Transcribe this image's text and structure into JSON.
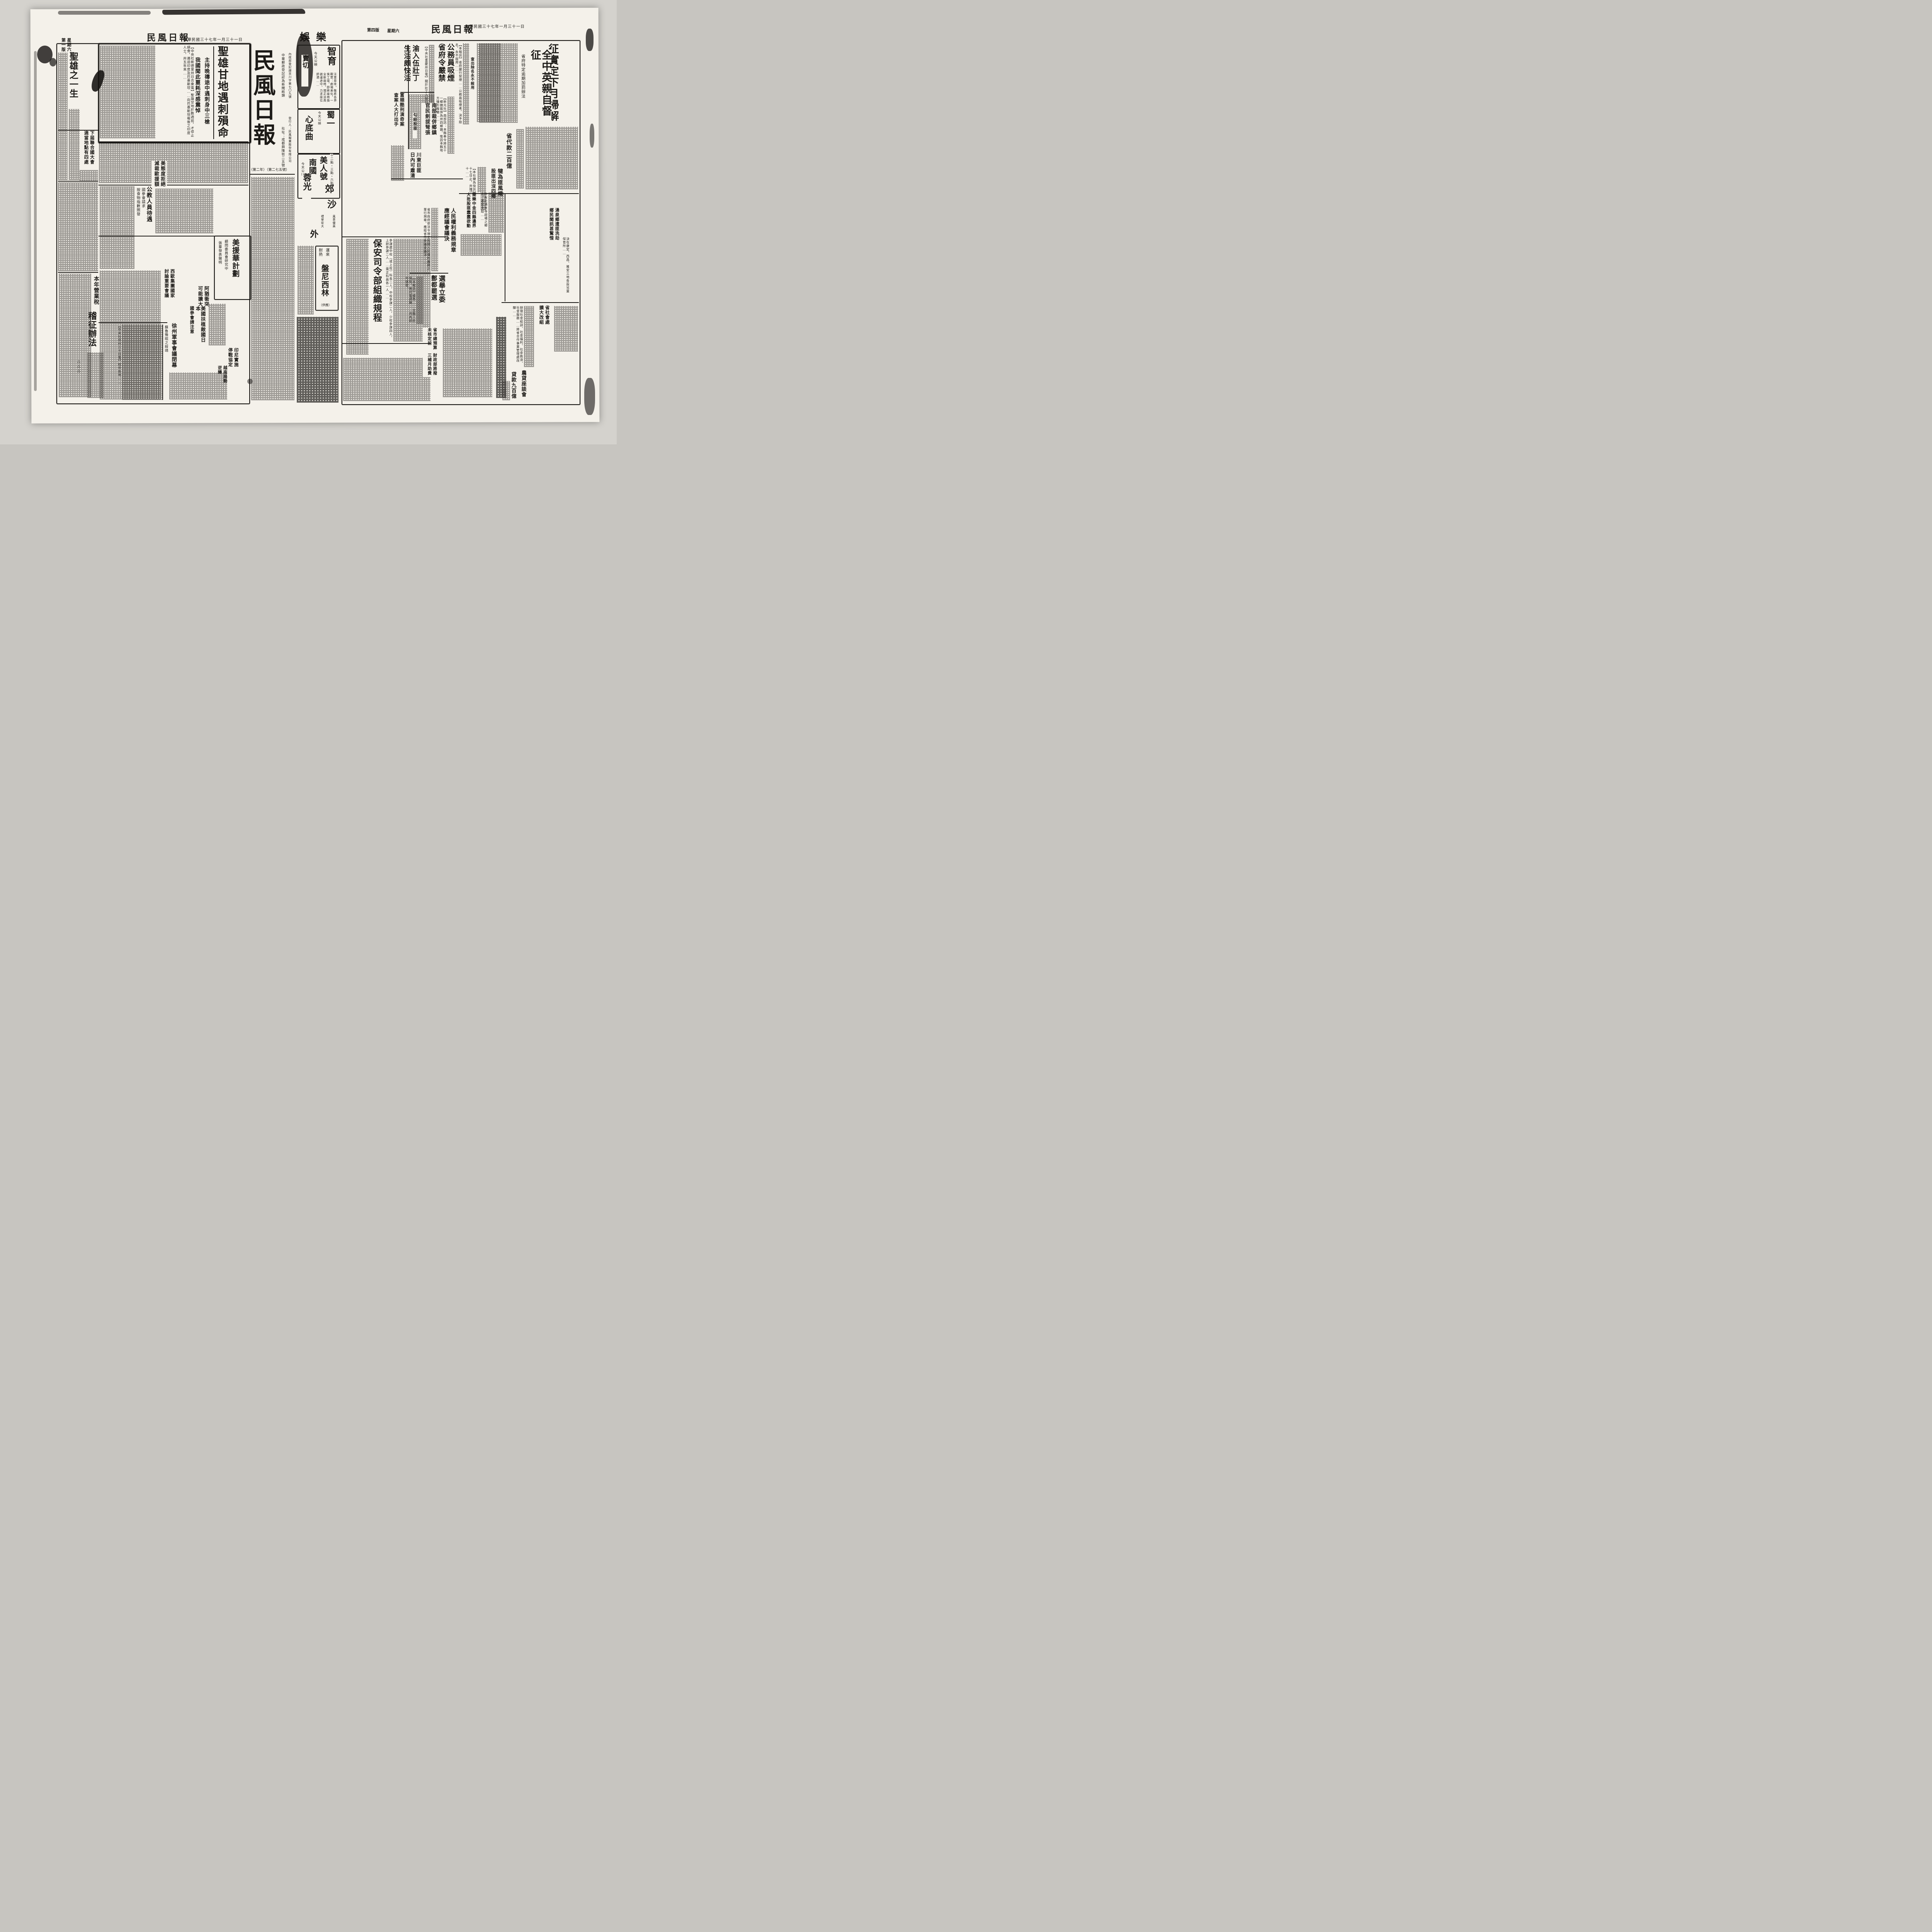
{
  "meta": {
    "paper_name": "民風日報",
    "date_line": "中華民國三十七年一月三十一日",
    "weekday": "星期六",
    "edition_left": "第一版",
    "edition_right": "第四版",
    "postal_reg": "中華郵政登記認為新聞紙類",
    "address": "社址：成都興隆街二五號",
    "license": "內政部登記證京川字第七〇九號",
    "publisher": "發行人：民風報業股份有限公司",
    "issue_no": "（第二年）（第二七五號）",
    "ink_color": "#1c1a17",
    "paper_color": "#f4f1ea"
  },
  "left": {
    "editorial_title": "聖雄之一生",
    "un": {
      "l1": "下屆聯合國大會",
      "l2": "適當地點有四處"
    },
    "gandhi": {
      "headline": "聖雄甘地遇刺殞命",
      "sub1": "主持晚禱途中遇刺身中三槍",
      "sub2": "我國聞此噩耗深感震悼",
      "body": "【中央社新德里卅日合衆電】聖雄甘地於數週前，才停止絕食，遏迫印度及巴基斯坦……向巴基斯坦報後之印度人士，卅五年來……"
    },
    "us_refusal": {
      "l1": "美態度拒絕",
      "l2": "減裁歐援額"
    },
    "pay": {
      "headline": "公教人員待遇",
      "sub1": "國參會請求",
      "sub2": "按食物指數照發"
    },
    "westbloc": {
      "l1": "西歐集團國家",
      "l2": "討論重要會議"
    },
    "aid": {
      "headline": "美援華計劃",
      "sub1": "顧問委員會研究中",
      "sub2": "張羣發表聲明"
    },
    "arab": {
      "l1": "阿猶衝突",
      "l2": "可能擴大"
    },
    "japan": {
      "l1": "美國扶植敵國日本",
      "l2": "國參會請注意"
    },
    "xuzhou": {
      "headline": "徐州軍事會議閉幕",
      "sub": "蘇魯豫晥之綏靖",
      "body": "【中央社徐州三十日電】晥中各地……"
    },
    "indo": {
      "l1": "印尼實施",
      "l2": "停戰協定"
    },
    "viet": {
      "l1": "越南局勢",
      "l2": "逆轉"
    },
    "tax": {
      "kicker": "本年營業稅",
      "headline": "稽征辦法"
    },
    "marks": "△△△"
  },
  "gutter": {
    "section": "娛樂",
    "cinema1": {
      "name": "智育",
      "note": "今天公映",
      "glyphs": "賣切",
      "notice": "注意是幸。敬希各界觀眾：劇場美化，一俟工竣，即將座椅換全新座椅，現正派員啟運途中，力求座位舒適……"
    },
    "cinema2": {
      "name": "蜀一",
      "film": "心底曲",
      "note": "今天公映"
    },
    "cinema3": {
      "name": "南國",
      "film": "美人號",
      "note": "今天公映",
      "times": "十二點・三點・六點"
    },
    "cinema4": {
      "name": "蓉光",
      "film_a": "郊",
      "film_b": "外",
      "extra": "沙",
      "blurb1": "風景優美",
      "blurb2": "禮堂宏大"
    }
  },
  "right": {
    "lead": {
      "h1": "征實定下月掃解",
      "h2": "全中英親自督征",
      "sub": "省府特定逾期加罰辦法"
    },
    "provloan": {
      "headline": "省代款二百億"
    },
    "qianwei": {
      "l1": "犍為匪風熾",
      "l2": "股匪出沒四鄉",
      "body": "【本社犍為快訊】至本月二十七日止，共殲滅匪徒七十……"
    },
    "smoke": {
      "l1": "公務員吸煙",
      "l2": "省府令嚴禁",
      "kicker": "查出除名永不敍用",
      "body": "【本報訊】省府嚴行禁煙……公務員吸煙者，決予除名，永不敍用……"
    },
    "yu": {
      "l1": "渝入伍壯丁",
      "l2": "生活頗快活",
      "body": "【中央社重慶卅日電】關於壯丁入營前後情形……"
    },
    "fushun": {
      "l1": "富順酷刑演奇案",
      "l2": "查案人大打出手"
    },
    "nanbu": {
      "kicker": "勾結股匪",
      "l1": "南部裁併鄉鎮",
      "l2": "官民劍拔弩張",
      "body": "【新元社】南部訊：本縣奉令將五十一鄉鎮裁併為卅四鄉鎮，惟因本縣地方情形複雜……"
    },
    "chuandong": {
      "l1": "川東巨匪",
      "l2": "日內可肅清"
    },
    "jianle": {
      "l1": "簡樂中金四縣邊界",
      "l2": "大批股匪蠢蠢欲動",
      "body": "昨有赴湧泉寺趕場之鄉人，遭受洗劫……"
    },
    "yongquan": {
      "l1": "湧泉鄉遭匪洗劫",
      "l2": "鄉民聞訊甚驚惶"
    },
    "rights": {
      "l1": "人民權利義務規章",
      "l2": "應經議會議決",
      "body": "省市政府依法令規定有關人民權利義務之單行規章，應經省市參議會議決……"
    },
    "elect": {
      "l1": "選舉立委",
      "l2": "鄷都罷選",
      "body": "【本報訊】據悉……全縣人民憤恨，曾代電請願……月內即可填發。"
    },
    "baoan": {
      "headline": "保安司令部組織規程",
      "body": "參謀處中校（或上校）科長二人，中校參謀二人，少校參謀四人，上尉參謀二人……需正科員各一人……"
    },
    "penicillin": {
      "kicker": "運來",
      "headline": "盤尼西林",
      "note": "耐熱",
      "tag": "（供應）"
    },
    "budget": {
      "l1": "省市總預算",
      "l2": "未核定前",
      "l3": "財政部將撥",
      "l4": "三補月助費"
    },
    "social": {
      "l1": "省社會處",
      "l2": "擴大改組",
      "body": "辦理社會組訓、社會福利、社會救濟、社會服務……將省合作事業管理處改隸……"
    },
    "farmloan": {
      "l1": "農貸座談會",
      "l2": "貸款九百億"
    },
    "childcare": {
      "body": "決在康定、西昌、雅安三地各設兒童保育所……"
    }
  }
}
